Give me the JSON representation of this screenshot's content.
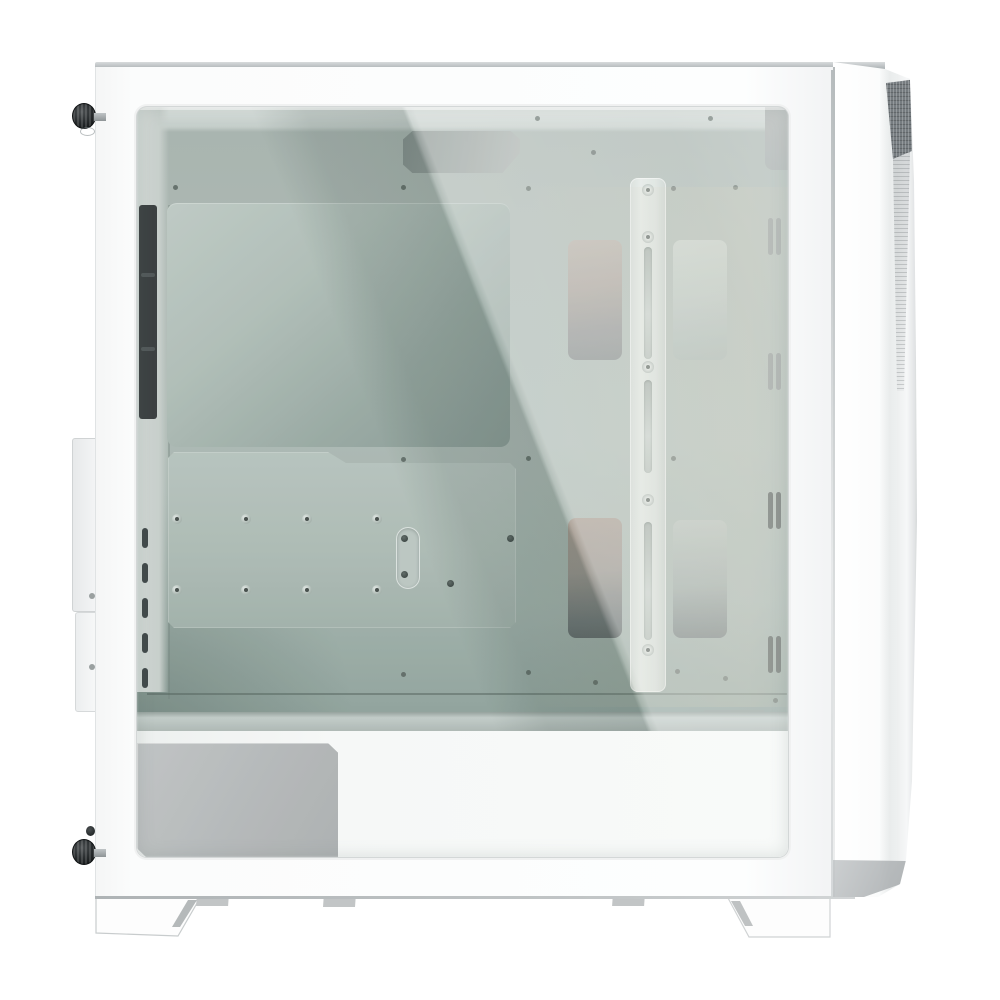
{
  "scene": {
    "label": "Product photo: white mid-tower ATX PC case, left-side view with tinted tempered-glass side panel showing empty interior",
    "background": "#ffffff",
    "visible_text": ""
  },
  "palette": {
    "case_white": "#fbfcfc",
    "edge_gray": "#b3b8ba",
    "interior_mid": "#a8b5b0",
    "interior_dark": "#7f918b",
    "reflection_white": "rgba(255,255,255,0.34)",
    "cutout_dark": "#394344",
    "mesh_dark": "#767c80",
    "psu_gray": "#b3b6b8",
    "screw_black": "#16191a",
    "standoff_dot": "#39413f",
    "vent_dark": "#414a49",
    "vent_light": "#868e8f",
    "foot_outline": "#c8cccd"
  },
  "parts": {
    "side_panel": "white steel side frame",
    "glass_panel": "tinted tempered glass window",
    "thumbscrew_top": "black knurled thumbscrew, top rear",
    "thumbscrew_bottom": "black knurled thumbscrew, bottom rear",
    "rear_protrusion": "rear I/O and expansion-slot bulge",
    "cable_grommet": "black vertical cable grommet strip",
    "motherboard_tray": "white motherboard tray with CPU backplate",
    "ssd_plate": "SSD/standoff mounting plate with 8 standoffs",
    "cable_cutouts": "two top cable-routing cutouts with angled corners",
    "fan_rail": "central slotted fan/radiator mounting rail",
    "fan_cutouts": "four rectangular fan mounting windows",
    "vent_slots": "four pairs of vertical vent slots on front wall",
    "psu_shroud": "white power-supply shroud",
    "psu_window": "gray PSU side cutout",
    "front_panel": "white angular front panel with dark mesh intake notch",
    "feet": "two angular white feet"
  }
}
